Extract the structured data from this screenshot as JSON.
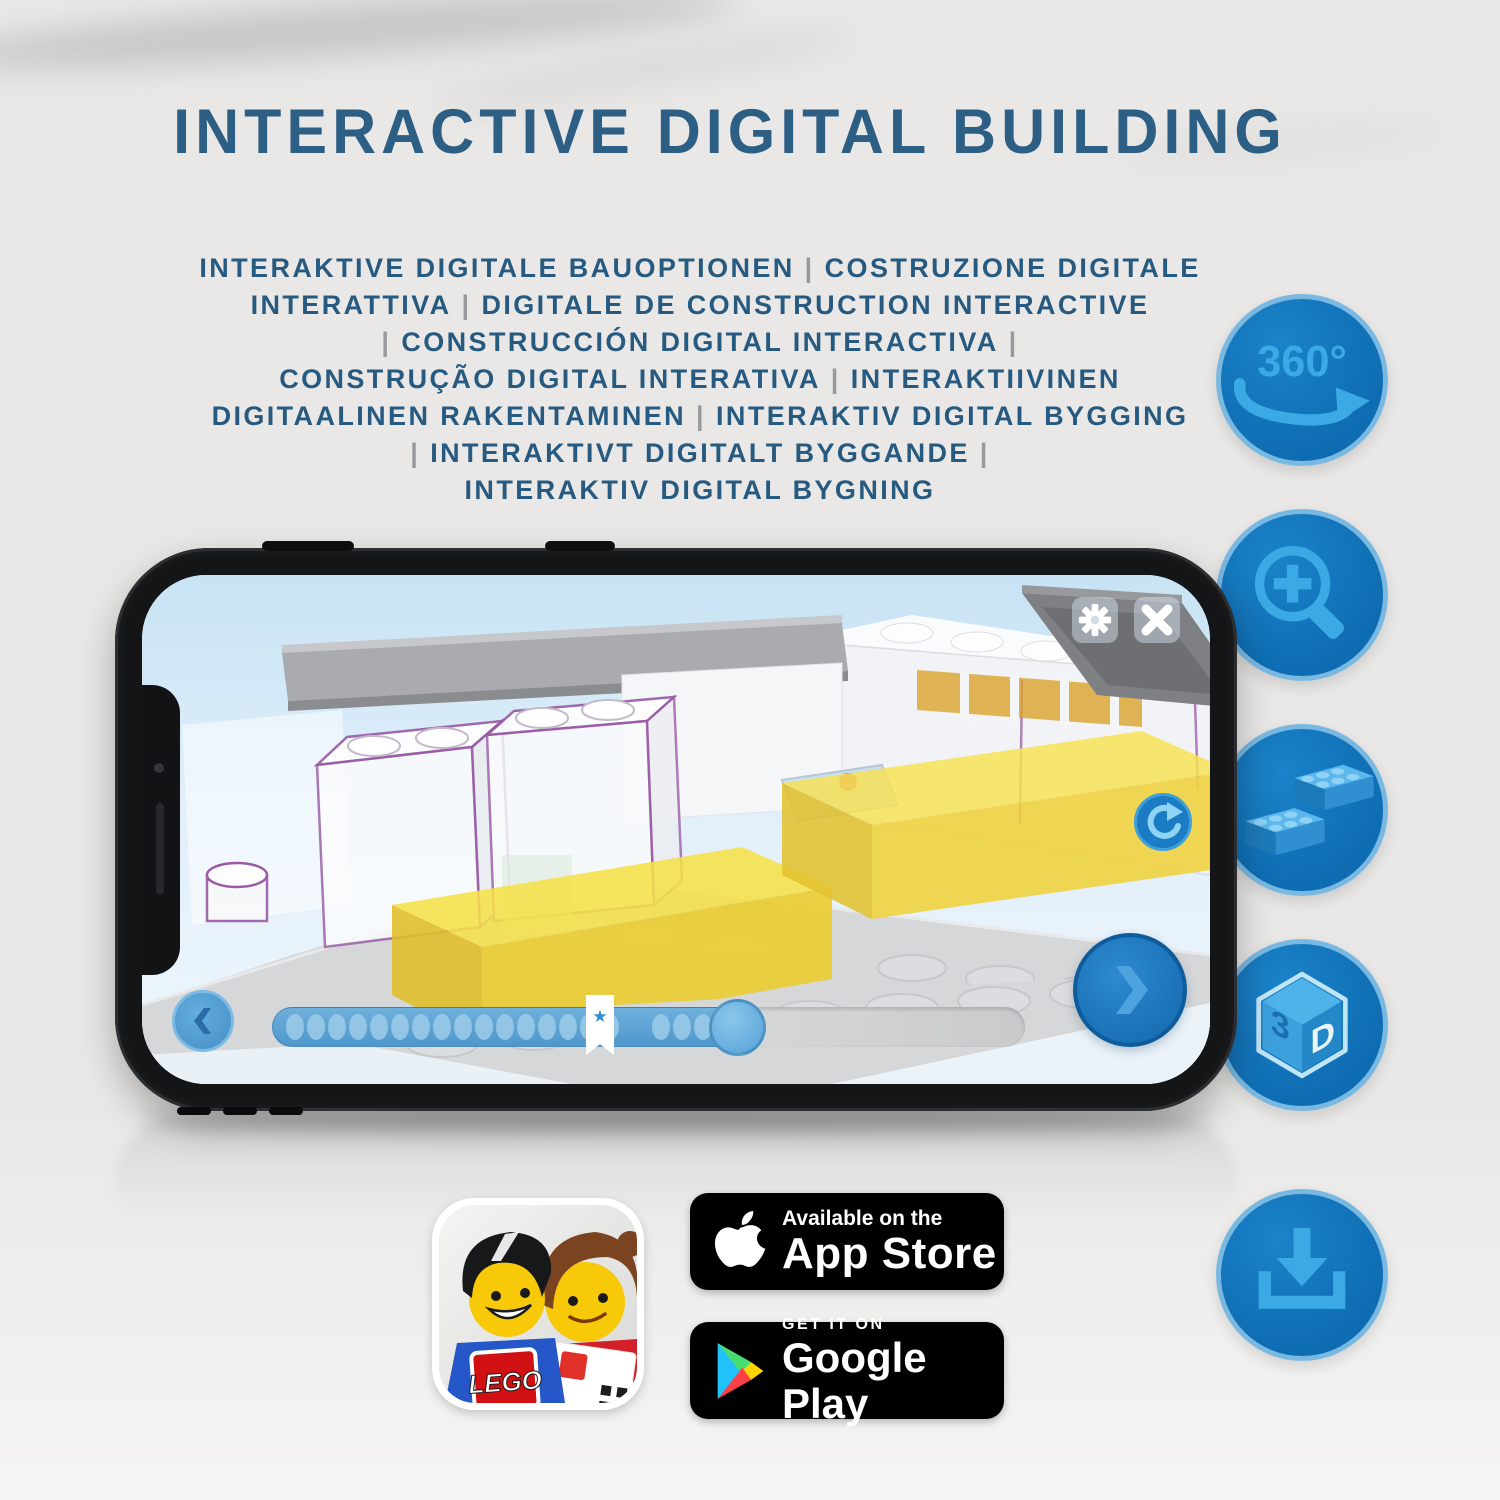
{
  "title": "INTERACTIVE DIGITAL BUILDING",
  "subtitle_lines": [
    "INTERAKTIVE DIGITALE BAUOPTIONEN | COSTRUZIONE DIGITALE",
    "INTERATTIVA | DIGITALE DE CONSTRUCTION INTERACTIVE",
    "| CONSTRUCCIÓN DIGITAL INTERACTIVA |",
    "CONSTRUÇÃO DIGITAL INTERATIVA | INTERAKTIIVINEN",
    "DIGITAALINEN RAKENTAMINEN | INTERAKTIV DIGITAL BYGGING",
    "| INTERAKTIVT DIGITALT BYGGANDE |",
    "INTERAKTIV DIGITAL BYGNING"
  ],
  "colors": {
    "title_blue": "#2d5e84",
    "circle_fill": "#0f6fb4",
    "circle_ring": "#79b8e1",
    "glyph_blue": "#3aa9e4",
    "brick_yellow": "#f2d83f",
    "outline_purple": "#9a5ba6",
    "slider_blue": "#5aa5d8"
  },
  "feature_icons": [
    {
      "name": "360-rotation-icon",
      "label": "360°"
    },
    {
      "name": "zoom-in-icon"
    },
    {
      "name": "lego-bricks-icon"
    },
    {
      "name": "3d-view-icon",
      "face_left": "3",
      "face_right": "D"
    },
    {
      "name": "download-icon"
    }
  ],
  "phone": {
    "app": {
      "icons": {
        "settings": "gear-icon",
        "close": "x-icon",
        "rotate": "rotate-arrow-icon",
        "back": "chevron-left-icon",
        "next": "chevron-right-icon",
        "bookmark_star": "★"
      },
      "progress": {
        "dots_before": 16,
        "dots_after": 4
      }
    }
  },
  "badges": {
    "lego_app": {
      "logo_text": "LEGO"
    },
    "app_store": {
      "line1": "Available on the",
      "line2": "App Store"
    },
    "google_play": {
      "line1": "GET IT ON",
      "line2": "Google Play"
    }
  }
}
